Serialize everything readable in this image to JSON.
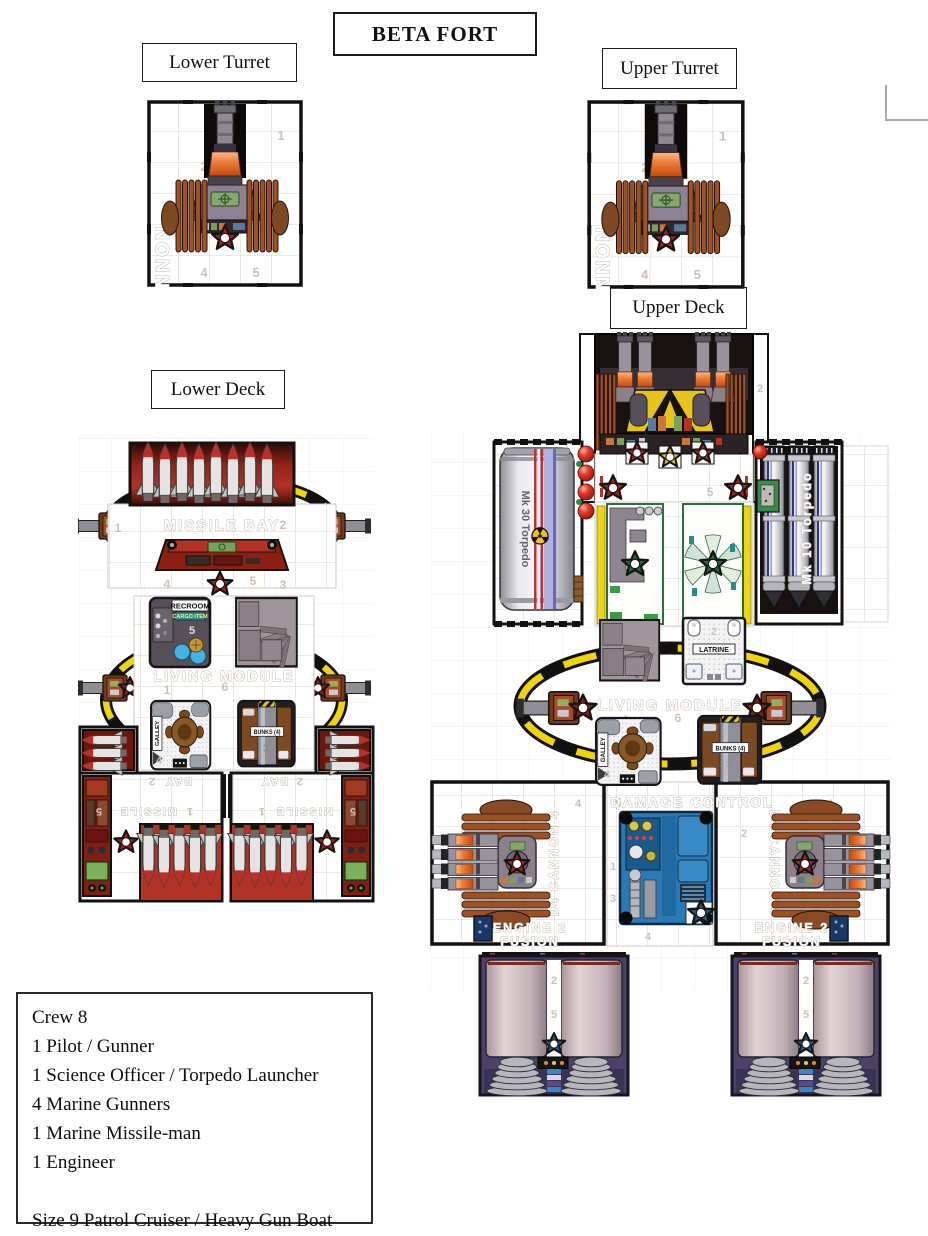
{
  "page": {
    "title": "BETA FORT",
    "labels": {
      "lower_turret": "Lower Turret",
      "upper_turret": "Upper Turret",
      "lower_deck": "Lower Deck",
      "upper_deck": "Upper Deck"
    }
  },
  "turret": {
    "wall_text": "CANNON",
    "cells": [
      "1",
      "2",
      "3",
      "4",
      "5"
    ]
  },
  "rooms": {
    "galley": "GALLEY",
    "bunks": "BUNKS (4)",
    "latrine": "LATRINE",
    "recroom": "RECROOM",
    "cargo": "CARGO ITEM"
  },
  "lower_deck": {
    "bay_front": {
      "name": "MISSILE BAY",
      "cells": [
        "1",
        "2",
        "4",
        "5",
        "3"
      ]
    },
    "living": {
      "name": "LIVING MODULE",
      "cells": [
        "1",
        "6"
      ],
      "recroom_cell": "5",
      "galley_cell": "4",
      "bunks_cell": "3"
    },
    "bay_aft": {
      "name_top": "BAY",
      "name_bottom": "MISSILE",
      "left_cells": [
        "2",
        "5",
        "1"
      ],
      "right_cells": [
        "2",
        "5",
        "1"
      ]
    }
  },
  "upper_deck": {
    "battery_cells": [
      "2",
      "5"
    ],
    "torpedo_left": "Mk 30 Torpedo",
    "torpedo_right": "Mk 10 Torpedo",
    "living": {
      "name": "LIVING MODULE",
      "cells": [
        "1",
        "6"
      ],
      "latrine_cell": "2",
      "galley_cell": "4",
      "bunks_cell": "3"
    },
    "damage_control": {
      "cell": "5",
      "name": "DAMAGE CONTROL",
      "cells": [
        "1",
        "3",
        "4"
      ]
    },
    "wing": {
      "name": "D4 CANNON 4",
      "left_cell": "4",
      "right_cell": "2",
      "right_cell2": "4"
    },
    "engine": {
      "line1": "ENGINE 2",
      "line2": "FUSION",
      "cells": [
        "2",
        "5"
      ]
    }
  },
  "crew_box": {
    "lines": [
      "Crew 8",
      "1 Pilot / Gunner",
      "1 Science Officer / Torpedo Launcher",
      "4 Marine Gunners",
      "1 Marine Missile-man",
      "1 Engineer",
      "",
      "Size 9 Patrol Cruiser / Heavy Gun Boat"
    ]
  },
  "colors": {
    "star_red": "#a8201f",
    "star_yellow": "#d6c235",
    "star_green": "#1e6e3a",
    "star_blue": "#1c5a8c",
    "ring_yellow": "#eed40e",
    "hull_orange": "#e8632c"
  }
}
